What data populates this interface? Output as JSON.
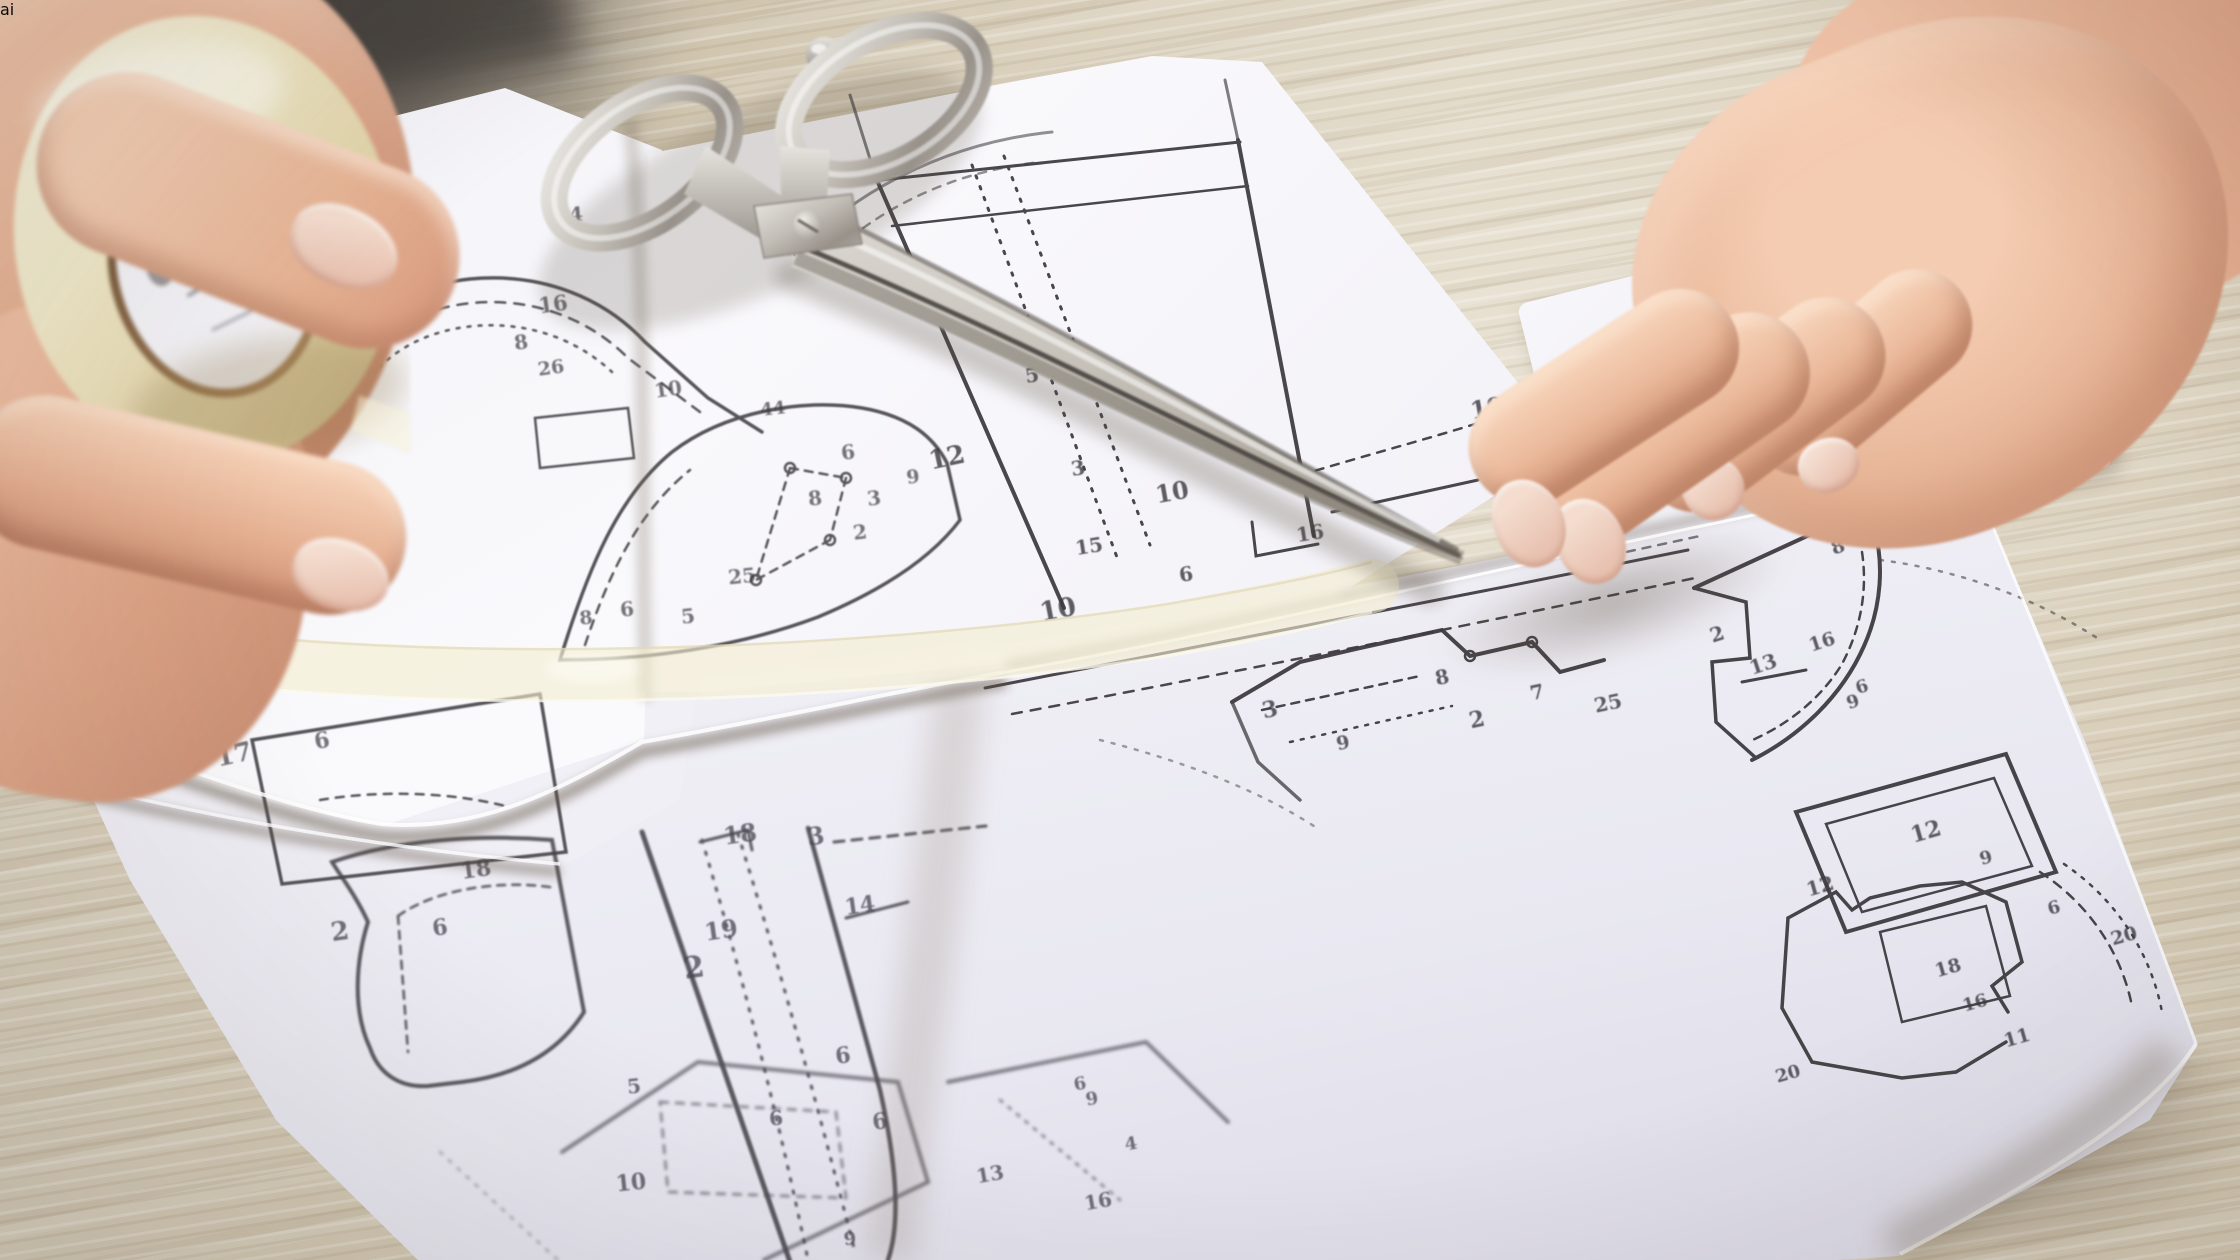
{
  "scene": {
    "type": "photograph",
    "description": "Two hands assemble printed paper sewing patterns on a light wooden table; the left hand holds a roll of clear tape, a strip of tape joins two sheets, large silver tailor scissors lie closed across the sheets, the right hand presses a sheet flat; small white paper scraps and a dark green pen tip lie on the wood; an ai watermark badge sits bottom right."
  },
  "watermark": {
    "text": "ai"
  },
  "objects": {
    "left_hand": "hand holding tape roll",
    "tape_roll": "roll of translucent cream tape",
    "tape_strip": "strip of tape across sheet seam",
    "scissors": "closed silver tailor scissors",
    "right_hand": "hand pressing pattern sheet",
    "pattern_sheets": "white printed sewing pattern sheets",
    "table": "light wooden table surface",
    "paper_scraps": "small cut paper scraps",
    "pen": "dark green pen tip at top right"
  },
  "colors": {
    "wood": "#d5cab5",
    "paper": "#f5f4f8",
    "tape": "#f0e9c8",
    "metal": "#c9c5be",
    "skin": "#e8b79b",
    "pattern_line": "#413e43",
    "watermark_bg": "#ffffff",
    "watermark_text": "#968c76"
  },
  "pattern_labels": {
    "sheet_a": [
      {
        "t": "16",
        "x": 357,
        "y": 164,
        "s": 20,
        "r": -6
      },
      {
        "t": "4",
        "x": 576,
        "y": 214,
        "s": 20,
        "r": -4
      },
      {
        "t": "16",
        "x": 553,
        "y": 304,
        "s": 21,
        "r": -8
      },
      {
        "t": "8",
        "x": 521,
        "y": 342,
        "s": 20,
        "r": -8
      },
      {
        "t": "26",
        "x": 551,
        "y": 368,
        "s": 19,
        "r": -8
      },
      {
        "t": "10",
        "x": 668,
        "y": 389,
        "s": 20,
        "r": -8
      },
      {
        "t": "44",
        "x": 773,
        "y": 409,
        "s": 18,
        "r": -6
      },
      {
        "t": "6",
        "x": 848,
        "y": 452,
        "s": 20,
        "r": -7
      },
      {
        "t": "9",
        "x": 913,
        "y": 477,
        "s": 19,
        "r": -7
      },
      {
        "t": "8",
        "x": 815,
        "y": 498,
        "s": 20,
        "r": -7
      },
      {
        "t": "3",
        "x": 874,
        "y": 498,
        "s": 20,
        "r": -7
      },
      {
        "t": "2",
        "x": 860,
        "y": 532,
        "s": 20,
        "r": -7
      },
      {
        "t": "25",
        "x": 742,
        "y": 576,
        "s": 20,
        "r": -6
      },
      {
        "t": "6",
        "x": 627,
        "y": 609,
        "s": 20,
        "r": -6
      },
      {
        "t": "5",
        "x": 688,
        "y": 616,
        "s": 20,
        "r": -6
      },
      {
        "t": "8",
        "x": 586,
        "y": 618,
        "s": 19,
        "r": -6
      },
      {
        "t": "12",
        "x": 163,
        "y": 522,
        "s": 24,
        "r": -10
      },
      {
        "t": "17",
        "x": 234,
        "y": 755,
        "s": 26,
        "r": -12
      },
      {
        "t": "6",
        "x": 322,
        "y": 741,
        "s": 22,
        "r": -10
      }
    ],
    "sheet_b": [
      {
        "t": "5",
        "x": 1032,
        "y": 375,
        "s": 20,
        "r": -9
      },
      {
        "t": "3",
        "x": 1078,
        "y": 468,
        "s": 20,
        "r": -9
      },
      {
        "t": "12",
        "x": 947,
        "y": 458,
        "s": 26,
        "r": -12
      },
      {
        "t": "10",
        "x": 1172,
        "y": 492,
        "s": 24,
        "r": -10
      },
      {
        "t": "8",
        "x": 1228,
        "y": 441,
        "s": 18,
        "r": -9
      },
      {
        "t": "15",
        "x": 1089,
        "y": 546,
        "s": 20,
        "r": -9
      },
      {
        "t": "16",
        "x": 1310,
        "y": 533,
        "s": 20,
        "r": -9
      },
      {
        "t": "6",
        "x": 1186,
        "y": 574,
        "s": 20,
        "r": -9
      },
      {
        "t": "10",
        "x": 1058,
        "y": 610,
        "s": 26,
        "r": -11
      },
      {
        "t": "19",
        "x": 1487,
        "y": 408,
        "s": 24,
        "r": -10
      }
    ],
    "sheet_c": [
      {
        "t": "1",
        "x": 1870,
        "y": 527,
        "s": 18,
        "r": -20
      },
      {
        "t": "8",
        "x": 1838,
        "y": 547,
        "s": 19,
        "r": -20
      },
      {
        "t": "2",
        "x": 1717,
        "y": 634,
        "s": 20,
        "r": -18
      },
      {
        "t": "16",
        "x": 1822,
        "y": 642,
        "s": 19,
        "r": -18
      },
      {
        "t": "13",
        "x": 1763,
        "y": 664,
        "s": 20,
        "r": -18
      },
      {
        "t": "6",
        "x": 1862,
        "y": 687,
        "s": 18,
        "r": -18
      },
      {
        "t": "9",
        "x": 1853,
        "y": 702,
        "s": 18,
        "r": -18
      },
      {
        "t": "12",
        "x": 1926,
        "y": 832,
        "s": 22,
        "r": -16
      },
      {
        "t": "12",
        "x": 1820,
        "y": 886,
        "s": 20,
        "r": -16
      },
      {
        "t": "9",
        "x": 1986,
        "y": 858,
        "s": 18,
        "r": -16
      },
      {
        "t": "6",
        "x": 2054,
        "y": 908,
        "s": 18,
        "r": -16
      },
      {
        "t": "20",
        "x": 2124,
        "y": 936,
        "s": 19,
        "r": -16
      },
      {
        "t": "18",
        "x": 1948,
        "y": 968,
        "s": 19,
        "r": -16
      },
      {
        "t": "16",
        "x": 1975,
        "y": 1003,
        "s": 18,
        "r": -16
      },
      {
        "t": "11",
        "x": 2017,
        "y": 1038,
        "s": 19,
        "r": -16
      },
      {
        "t": "20",
        "x": 1788,
        "y": 1074,
        "s": 18,
        "r": -16
      },
      {
        "t": "8",
        "x": 1442,
        "y": 677,
        "s": 20,
        "r": -12
      },
      {
        "t": "3",
        "x": 1270,
        "y": 710,
        "s": 22,
        "r": -12
      },
      {
        "t": "2",
        "x": 1477,
        "y": 720,
        "s": 22,
        "r": -12
      },
      {
        "t": "9",
        "x": 1343,
        "y": 743,
        "s": 19,
        "r": -12
      },
      {
        "t": "7",
        "x": 1537,
        "y": 692,
        "s": 20,
        "r": -12
      },
      {
        "t": "25",
        "x": 1608,
        "y": 703,
        "s": 20,
        "r": -12
      },
      {
        "t": "3",
        "x": 1562,
        "y": 552,
        "s": 18,
        "r": -12
      }
    ],
    "sheet_d": [
      {
        "t": "18",
        "x": 476,
        "y": 870,
        "s": 22,
        "r": -8
      },
      {
        "t": "6",
        "x": 440,
        "y": 928,
        "s": 22,
        "r": -8
      },
      {
        "t": "2",
        "x": 340,
        "y": 932,
        "s": 26,
        "r": -8
      },
      {
        "t": "18",
        "x": 740,
        "y": 834,
        "s": 24,
        "r": -8
      },
      {
        "t": "3",
        "x": 816,
        "y": 836,
        "s": 24,
        "r": -8
      },
      {
        "t": "19",
        "x": 721,
        "y": 930,
        "s": 24,
        "r": -8
      },
      {
        "t": "2",
        "x": 694,
        "y": 968,
        "s": 30,
        "r": -8
      },
      {
        "t": "14",
        "x": 860,
        "y": 906,
        "s": 22,
        "r": -8
      },
      {
        "t": "6",
        "x": 843,
        "y": 1056,
        "s": 22,
        "r": -8
      },
      {
        "t": "6",
        "x": 880,
        "y": 1122,
        "s": 22,
        "r": -8
      },
      {
        "t": "5",
        "x": 634,
        "y": 1086,
        "s": 20,
        "r": -6
      },
      {
        "t": "6",
        "x": 776,
        "y": 1118,
        "s": 20,
        "r": -6
      },
      {
        "t": "10",
        "x": 631,
        "y": 1183,
        "s": 22,
        "r": -6
      },
      {
        "t": "13",
        "x": 990,
        "y": 1174,
        "s": 20,
        "r": -10
      },
      {
        "t": "16",
        "x": 1098,
        "y": 1201,
        "s": 20,
        "r": -10
      },
      {
        "t": "6",
        "x": 1080,
        "y": 1084,
        "s": 18,
        "r": -10
      },
      {
        "t": "9",
        "x": 1092,
        "y": 1099,
        "s": 18,
        "r": -10
      },
      {
        "t": "4",
        "x": 1131,
        "y": 1144,
        "s": 18,
        "r": -10
      },
      {
        "t": "9",
        "x": 850,
        "y": 1239,
        "s": 18,
        "r": -6
      }
    ]
  }
}
